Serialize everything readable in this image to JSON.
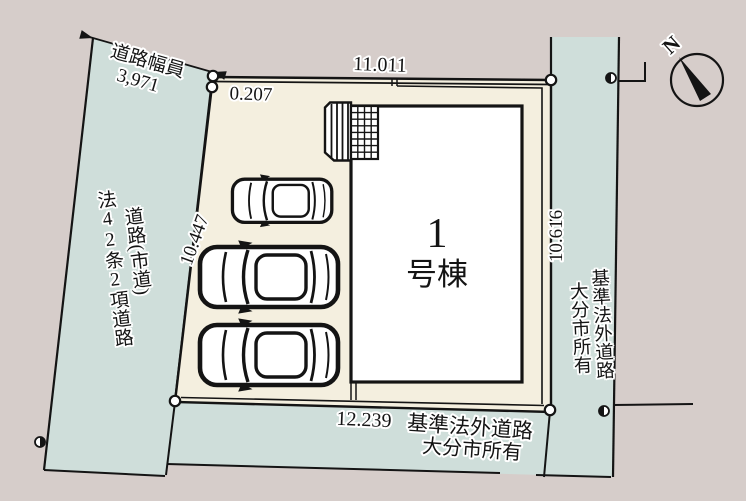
{
  "colors": {
    "background": "#d6cdca",
    "road": "#cfdeda",
    "lot": "#f4efdf",
    "building": "#ffffff",
    "line": "#141414"
  },
  "measurements": {
    "top_width": "11.011",
    "corner_offset": "0.207",
    "left_depth": "10.447",
    "right_depth": "10.616",
    "bottom_width": "12.239"
  },
  "left_road": {
    "width_label": "道路幅員",
    "width_value": "3,971",
    "name": "道路(市道)",
    "classification": "法42条2項道路"
  },
  "right_road": {
    "name": "基準法外道路",
    "owner": "大分市所有"
  },
  "bottom_road": {
    "name": "基準法外道路",
    "owner": "大分市所有"
  },
  "building": {
    "number": "1",
    "suffix": "号棟"
  },
  "compass": {
    "north": "N"
  }
}
